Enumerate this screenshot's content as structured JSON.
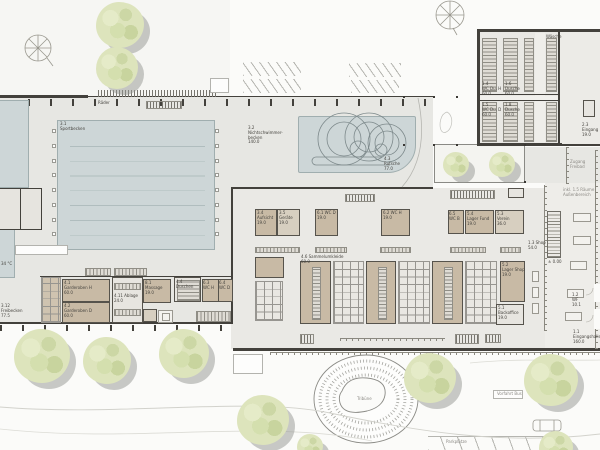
{
  "colors": {
    "pool": "#cdd6d7",
    "room_tan": "#c8baa5",
    "wall": "#43413c",
    "deck": "#e7e7e3",
    "tree": "#dde4bc",
    "background": "#fbfbf9"
  },
  "labels": {
    "raeder": "Räder",
    "sportbecken": "3.1\nSportbecken",
    "nichtschwimmer": "3.2\nNichtschwimmer-\nbecken\n140.0",
    "rutsche": "4.3\nRutsche\n77.0",
    "zugang_freibad": "Zugang Freibad",
    "waesche": "Wäsche",
    "wc_du_h": "1.4\nWC Du. H\n60.0",
    "dusche_h": "1.6\nDusche\n60.0",
    "wc_du_d": "1.5\nWC Du. D\n60.0",
    "dusche_d": "1.8\nDusche\n60.0",
    "eingang_freibad": "2.3\nEingang\n19.0",
    "raume_aussen": "inkl. 1.5 Räume\nAußenbereich",
    "aufsicht": "3.4\nAufsicht\n19.0",
    "geraete": "3.5\nGeräte\n19.0",
    "wc_d1": "6.1 WC D\n19.0",
    "wc_h1": "6.2 WC H\n19.0",
    "wc_b": "6.5\nWC B",
    "lager_fund": "5.4\nLager Fund\n19.0",
    "verein": "5.3\nVerein\n36.0",
    "lager_shop": "5.2\nLager Shop\n19.0",
    "backoffice": "5.1\nBackoffice\n19.0",
    "shop": "1.3 Shop\n54.0",
    "level": "± 0.00",
    "windfang": "1.2\nWF\n10.1",
    "eingangshalle": "1.1\nEingangshalle\n160.0",
    "umkleide1": "4.6 Sammelumkleide\n60.0",
    "garderoben_h": "4.1\nGarderoben H\n60.0",
    "garderoben_d": "4.2\nGarderoben D\n60.0",
    "ablage": "4.11 Ablage\n24.0",
    "massage": "8.1\nMassage\n19.0",
    "wc_h2": "6.3 WC H",
    "wc_d2": "6.4 WC D",
    "duschen": "4.4\nDuschen",
    "freibecken": "3.12\nFreibecken\n77.5",
    "temp": "34 °C",
    "tribune": "Tribüne",
    "vorfahrt": "Vorfahrt Bus",
    "parkplaetze": "Parkplätze"
  }
}
